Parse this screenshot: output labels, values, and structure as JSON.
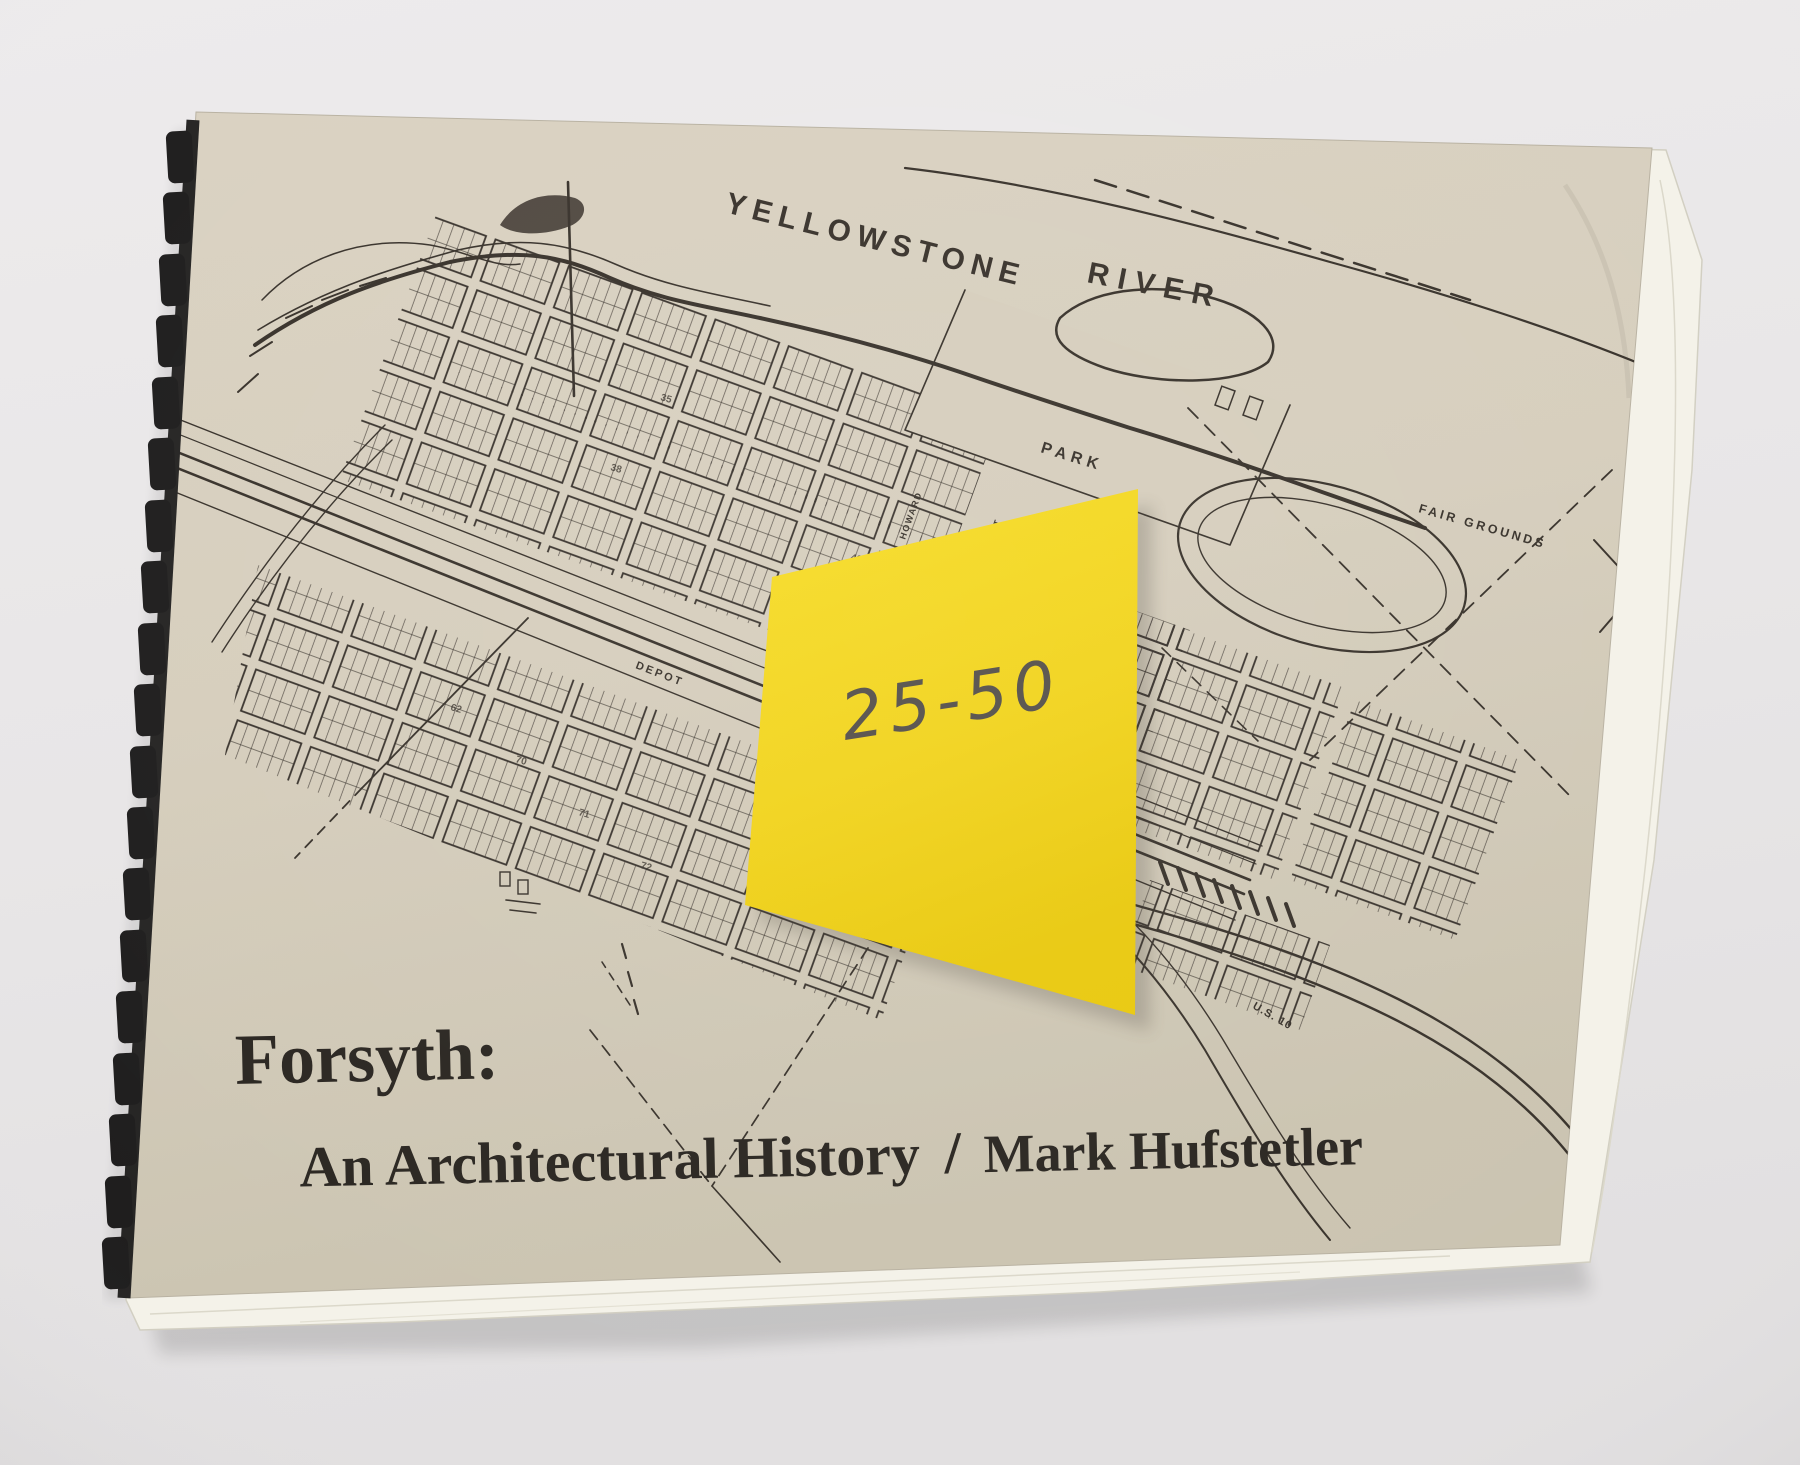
{
  "book": {
    "title_line1": "Forsyth:",
    "title_line2": "An Architectural History",
    "title_separator": "/",
    "author": "Mark Hufstetler"
  },
  "sticky_note": {
    "text": "25-50",
    "color": "#f2d41e"
  },
  "map": {
    "labels": [
      {
        "text": "YELLOWSTONE"
      },
      {
        "text": "RIVER"
      },
      {
        "text": "PARK"
      },
      {
        "text": "FAIR GROUNDS"
      },
      {
        "text": "DEPOT"
      },
      {
        "text": "U.S. 10"
      },
      {
        "text": "HOWARD"
      },
      {
        "text": "STREET"
      }
    ],
    "block_numbers": [
      "35",
      "38",
      "43",
      "16",
      "62",
      "70",
      "71",
      "72"
    ]
  },
  "colors": {
    "photo_background": "#e9e7e8",
    "cover_paper": "#d6cebd",
    "map_ink": "#39332c",
    "comb_binding": "#1f1e1e",
    "page_edges": "#f4f2e9",
    "sticky_note": "#f2d41e"
  }
}
